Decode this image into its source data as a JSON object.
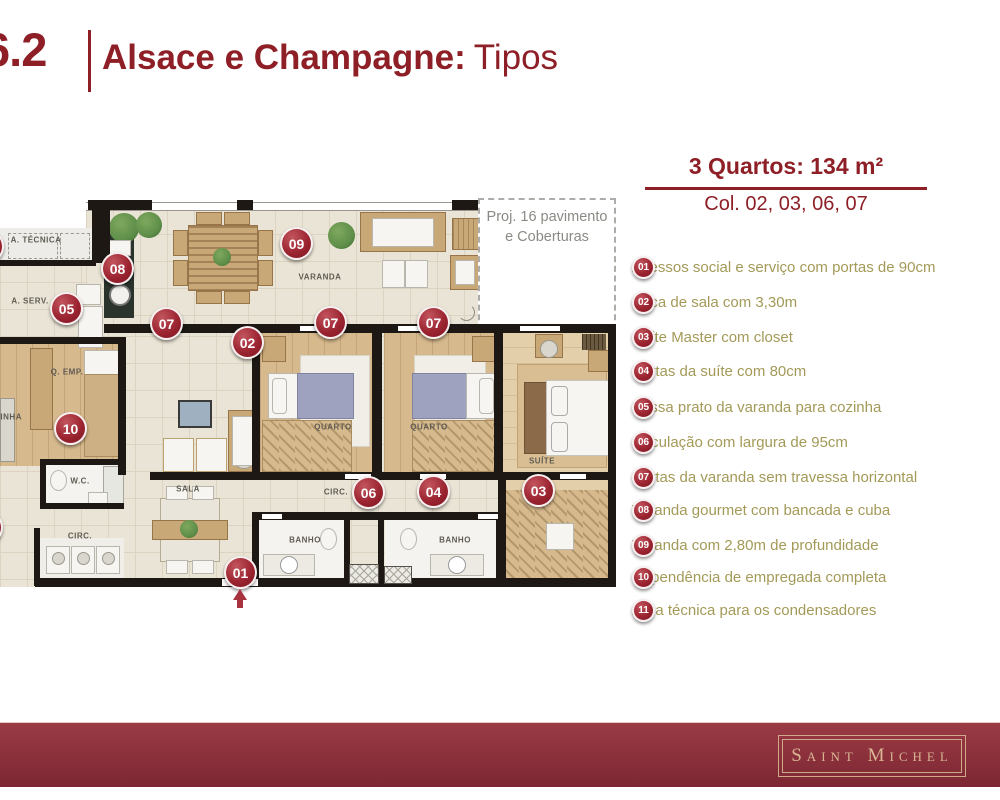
{
  "slide": {
    "section_number": "6.2",
    "title_bold": "Alsace e Champagne:",
    "title_light": "Tipos"
  },
  "summary": {
    "heading": "3 Quartos: 134 m²",
    "columns": "Col. 02, 03, 06, 07"
  },
  "legend": {
    "items": [
      {
        "num": "01",
        "text": "Acessos social e serviço com portas de 90cm",
        "y": 270
      },
      {
        "num": "02",
        "text": "Boca de sala com 3,30m",
        "y": 305
      },
      {
        "num": "03",
        "text": "Suíte Master com closet",
        "y": 340
      },
      {
        "num": "04",
        "text": "Portas da suíte com 80cm",
        "y": 374
      },
      {
        "num": "05",
        "text": "Passa prato da varanda para cozinha",
        "y": 410
      },
      {
        "num": "06",
        "text": "Circulação com largura de 95cm",
        "y": 445
      },
      {
        "num": "07",
        "text": "Portas da varanda sem travessa horizontal",
        "y": 480
      },
      {
        "num": "08",
        "text": "Varanda gourmet com bancada e cuba",
        "y": 513
      },
      {
        "num": "09",
        "text": "Varanda com 2,80m de profundidade",
        "y": 548
      },
      {
        "num": "10",
        "text": "Dependência de empregada completa",
        "y": 580
      },
      {
        "num": "11",
        "text": "Área técnica para os condensadores",
        "y": 613
      }
    ]
  },
  "floorplan": {
    "note_line1": "Proj. 16 pavimento",
    "note_line2": "e Coberturas",
    "badges": [
      {
        "num": "11",
        "x": -13,
        "y": 246
      },
      {
        "num": "08",
        "x": 117,
        "y": 268
      },
      {
        "num": "05",
        "x": 66,
        "y": 308
      },
      {
        "num": "09",
        "x": 296,
        "y": 243
      },
      {
        "num": "07",
        "x": 166,
        "y": 323
      },
      {
        "num": "02",
        "x": 247,
        "y": 342
      },
      {
        "num": "07",
        "x": 330,
        "y": 322
      },
      {
        "num": "07",
        "x": 433,
        "y": 322
      },
      {
        "num": "10",
        "x": 70,
        "y": 428
      },
      {
        "num": "06",
        "x": 368,
        "y": 492
      },
      {
        "num": "04",
        "x": 433,
        "y": 491
      },
      {
        "num": "03",
        "x": 538,
        "y": 490
      },
      {
        "num": "01",
        "x": 240,
        "y": 572
      },
      {
        "num": "",
        "x": -14,
        "y": 527
      }
    ],
    "room_labels": [
      {
        "t": "A. TÉCNICA",
        "x": 36,
        "y": 240
      },
      {
        "t": "A. SERV.",
        "x": 30,
        "y": 301
      },
      {
        "t": "Q. EMP.",
        "x": 67,
        "y": 372
      },
      {
        "t": "COZINHA",
        "x": 2,
        "y": 417
      },
      {
        "t": "W.C.",
        "x": 80,
        "y": 481
      },
      {
        "t": "CIRC.",
        "x": 80,
        "y": 536
      },
      {
        "t": "SALA",
        "x": 188,
        "y": 489
      },
      {
        "t": "VARANDA",
        "x": 320,
        "y": 277
      },
      {
        "t": "QUARTO",
        "x": 333,
        "y": 427
      },
      {
        "t": "QUARTO",
        "x": 429,
        "y": 427
      },
      {
        "t": "SUÍTE",
        "x": 542,
        "y": 461
      },
      {
        "t": "CIRC.",
        "x": 336,
        "y": 492
      },
      {
        "t": "BANHO",
        "x": 305,
        "y": 540
      },
      {
        "t": "BANHO",
        "x": 455,
        "y": 540
      }
    ]
  },
  "footer": {
    "brand": "Saint Michel"
  },
  "colors": {
    "accent_red": "#8e1f26",
    "badge_red": "#9c2531",
    "legend_text": "#a39a58",
    "footer_bar": "#8d323d",
    "brand_gold": "#d9b593"
  }
}
